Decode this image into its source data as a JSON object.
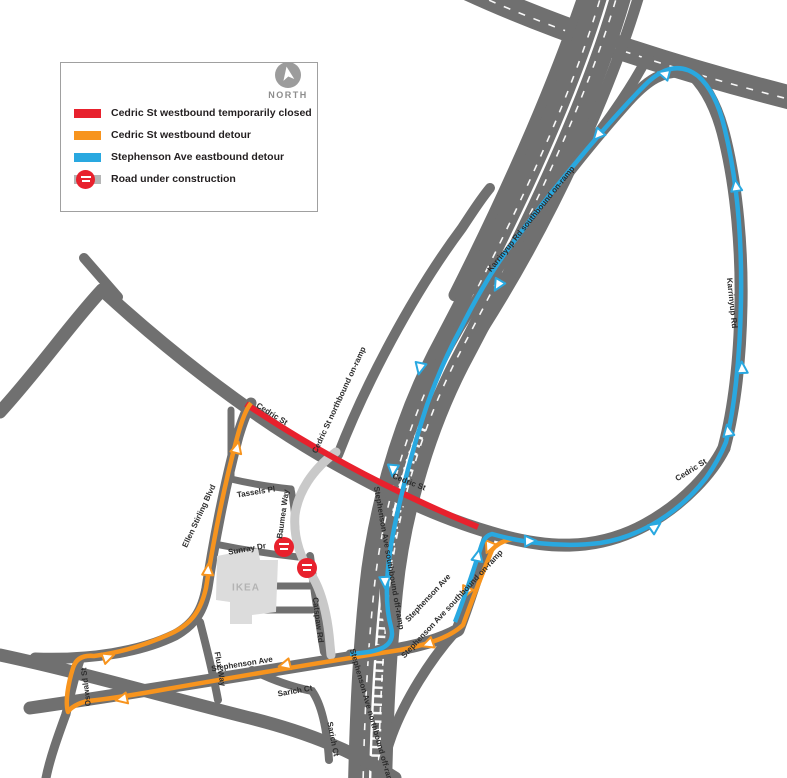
{
  "colors": {
    "closed_red": "#e8212d",
    "detour_orange": "#f7941e",
    "detour_blue": "#29a8e0",
    "road_gray": "#707070",
    "construction_gray": "#c9c9c9"
  },
  "legend": {
    "items": [
      {
        "swatch": "red",
        "label": "Cedric St westbound temporarily closed"
      },
      {
        "swatch": "orange",
        "label": "Cedric St westbound detour"
      },
      {
        "swatch": "blue",
        "label": "Stephenson Ave eastbound detour"
      },
      {
        "swatch": "gray",
        "label": "Road under construction"
      }
    ]
  },
  "north_label": "NORTH",
  "map": {
    "labels": [
      {
        "id": "cedric-st-west",
        "text": "Cedric St"
      },
      {
        "id": "cedric-st-mid",
        "text": "Cedric St"
      },
      {
        "id": "cedric-st-east",
        "text": "Cedric St"
      },
      {
        "id": "karrinyup-rd",
        "text": "Karrinyup Rd"
      },
      {
        "id": "karrinyup-sb-onramp",
        "text": "Karrinyup Rd southbound on-ramp"
      },
      {
        "id": "cedric-nb-onramp",
        "text": "Cedric St northbound on-ramp"
      },
      {
        "id": "mitchell-fwy-north",
        "text": "Mitchell Fwy North"
      },
      {
        "id": "mitchell-fwy-south",
        "text": "Mitchell Fwy South"
      },
      {
        "id": "stephenson-sb-offramp",
        "text": "Stephenson Ave southbound off-ramp"
      },
      {
        "id": "stephenson-ave-diagonal",
        "text": "Stephenson Ave"
      },
      {
        "id": "stephenson-sb-onramp",
        "text": "Stephenson Ave southbound on-ramp"
      },
      {
        "id": "stephenson-ave-horizontal",
        "text": "Stephenson Ave"
      },
      {
        "id": "stephenson-nb-offramp",
        "text": "Stephenson Ave northbound off-ramp"
      },
      {
        "id": "sarich-ct-1",
        "text": "Sarich Ct"
      },
      {
        "id": "sarich-ct-2",
        "text": "Sarich Ct"
      },
      {
        "id": "flux-way",
        "text": "Flux Way"
      },
      {
        "id": "oswald-st",
        "text": "Oswald St"
      },
      {
        "id": "ellen-stirling-blvd",
        "text": "Ellen Stirling Blvd"
      },
      {
        "id": "tassels-pl",
        "text": "Tassels Pl"
      },
      {
        "id": "baumea-way",
        "text": "Baumea Way"
      },
      {
        "id": "sunray-dr",
        "text": "Sunray Dr"
      },
      {
        "id": "catspaw-rd",
        "text": "Catspaw Rd"
      },
      {
        "id": "ikea",
        "text": "IKEA"
      }
    ]
  }
}
